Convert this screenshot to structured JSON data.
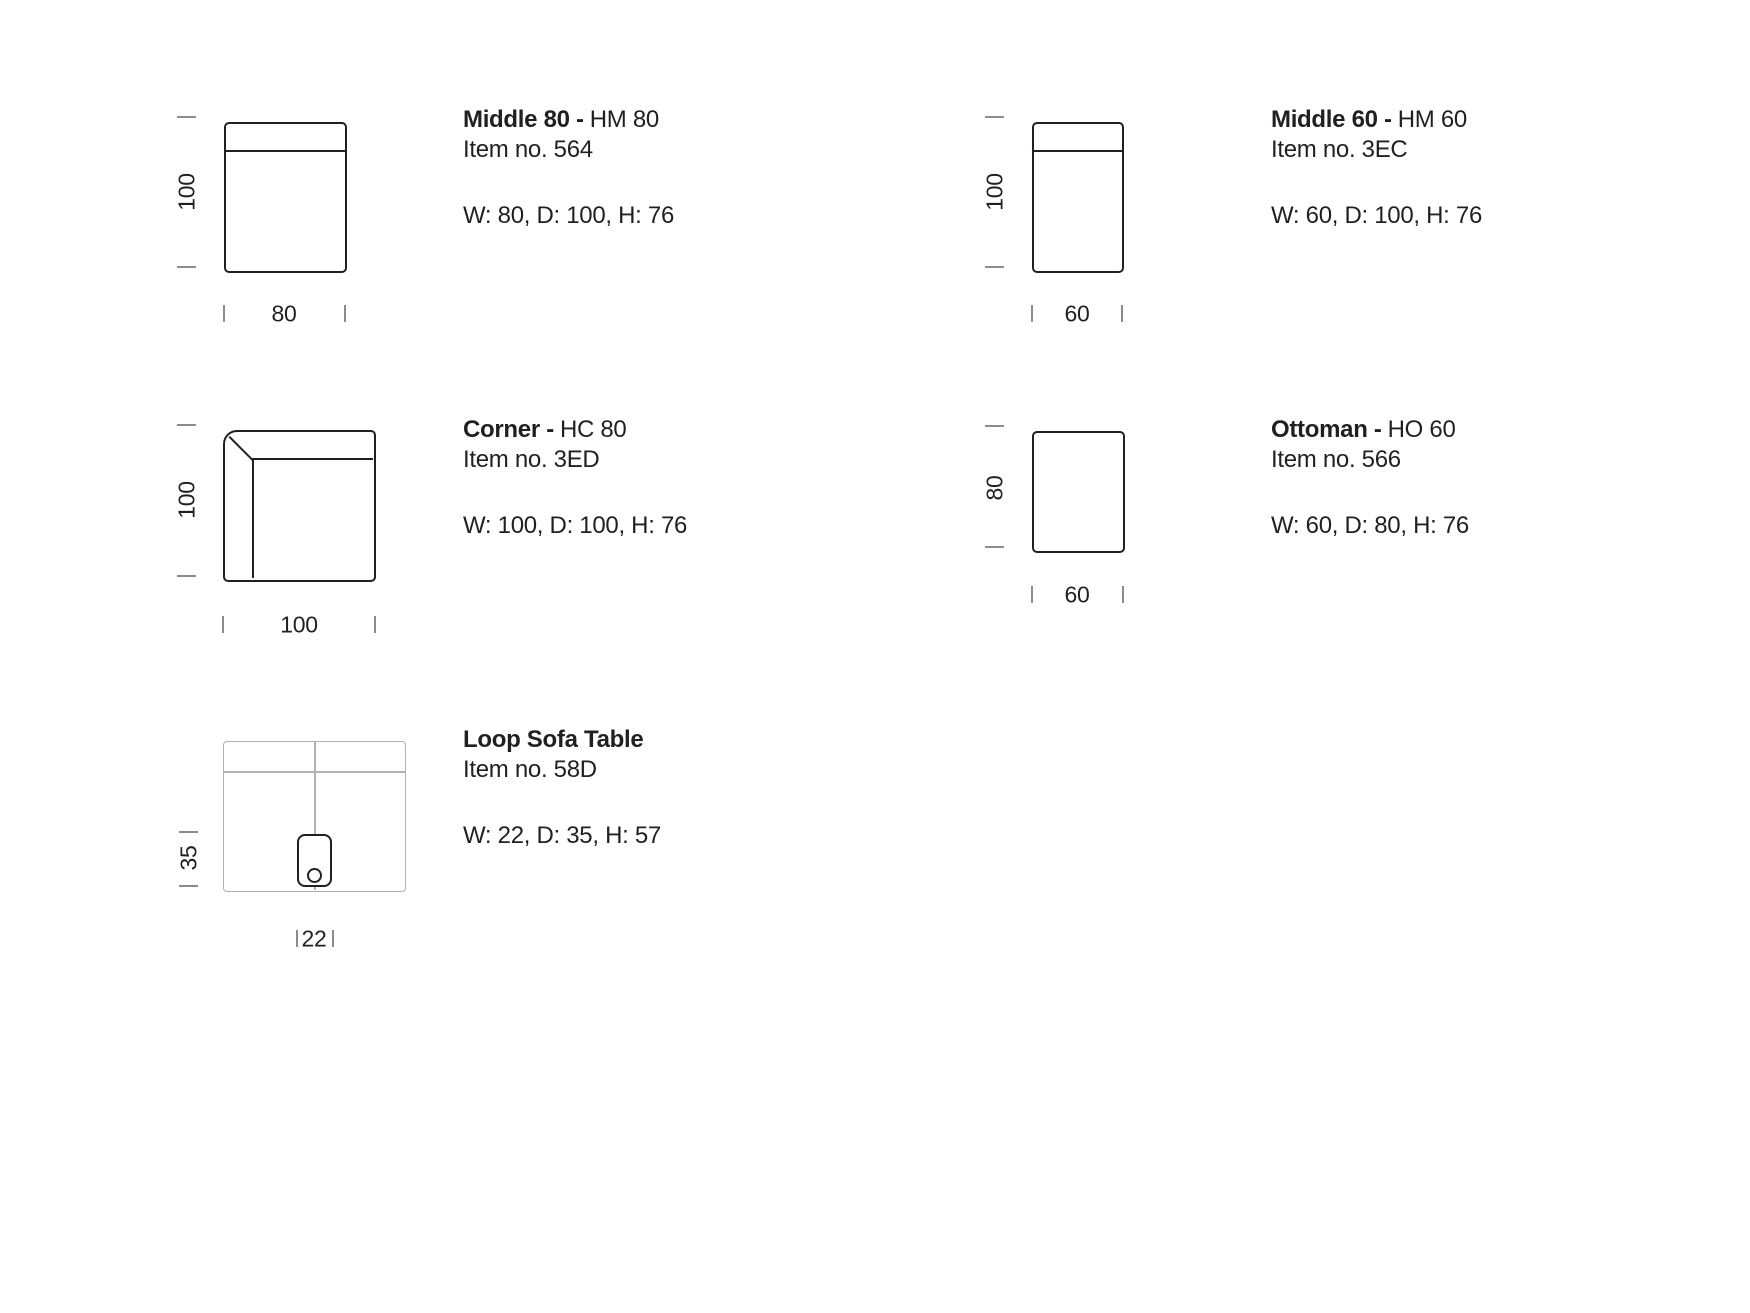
{
  "colors": {
    "ink": "#231f20",
    "tick": "#8c8c8c",
    "light_line": "#b2b2b2"
  },
  "products": [
    {
      "title_bold": "Middle 80 -",
      "title_code": "HM 80",
      "item_no": "Item no. 564",
      "specs": "W: 80, D: 100, H: 76",
      "depth_dim": "100",
      "width_dim": "80"
    },
    {
      "title_bold": "Middle 60 -",
      "title_code": "HM 60",
      "item_no": "Item no. 3EC",
      "specs": "W: 60, D: 100, H: 76",
      "depth_dim": "100",
      "width_dim": "60"
    },
    {
      "title_bold": "Corner -",
      "title_code": "HC 80",
      "item_no": "Item no. 3ED",
      "specs": "W: 100, D: 100, H: 76",
      "depth_dim": "100",
      "width_dim": "100"
    },
    {
      "title_bold": "Ottoman -",
      "title_code": "HO 60",
      "item_no": "Item no. 566",
      "specs": "W: 60, D: 80, H: 76",
      "depth_dim": "80",
      "width_dim": "60"
    },
    {
      "title_bold": "Loop Sofa Table",
      "title_code": "",
      "item_no": "Item no. 58D",
      "specs": "W: 22, D: 35, H: 57",
      "depth_dim": "35",
      "width_dim": "22"
    }
  ]
}
